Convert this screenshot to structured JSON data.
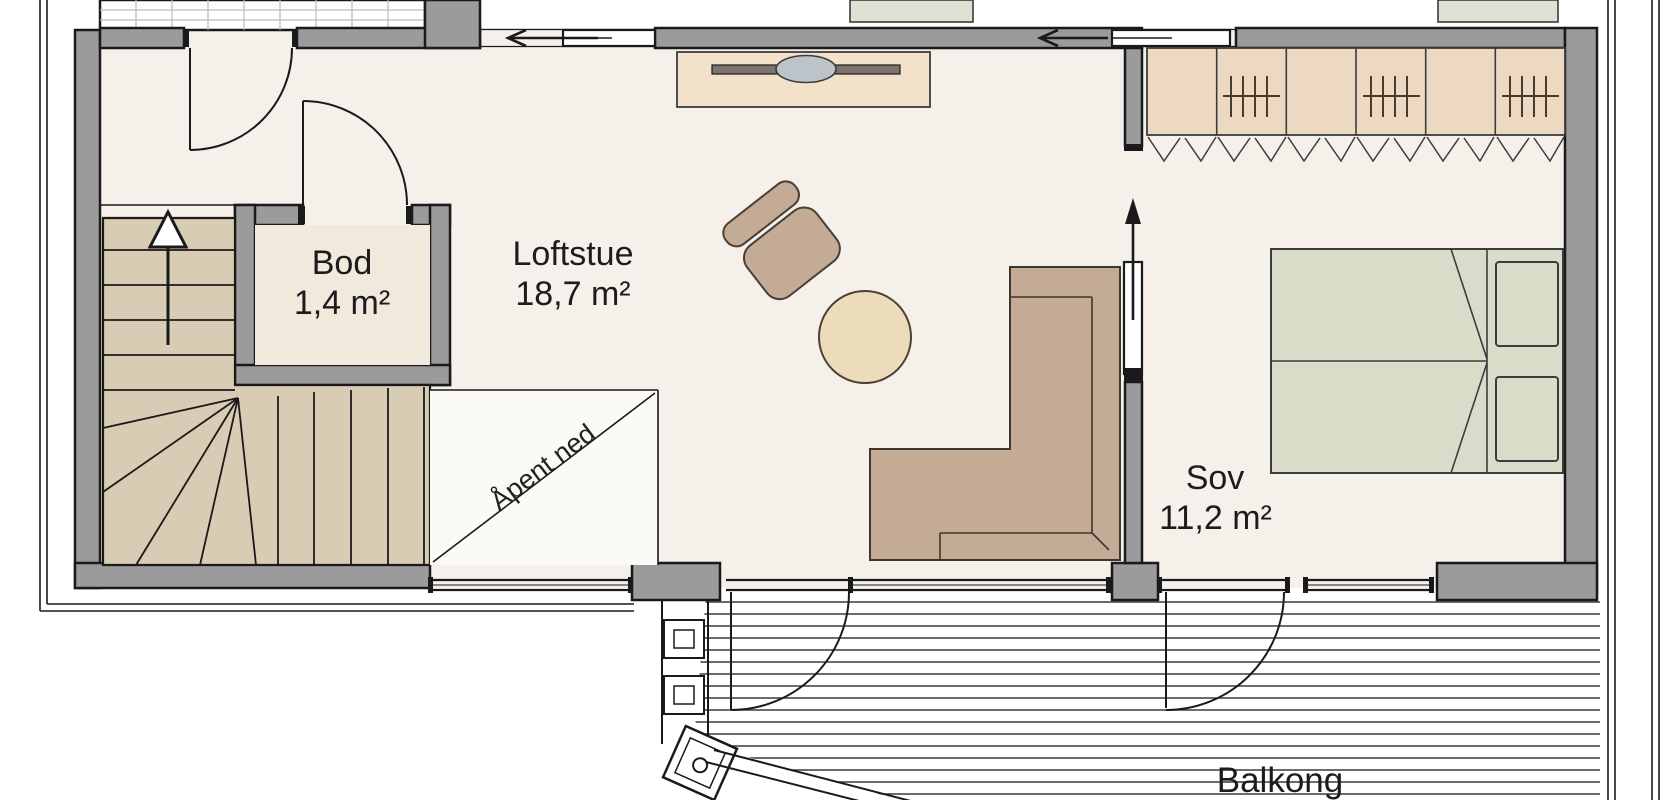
{
  "rooms": [
    {
      "name": "Bod",
      "area": "1,4 m²"
    },
    {
      "name": "Loftstue",
      "area": "18,7 m²"
    },
    {
      "name": "Sov",
      "area": "11,2 m²"
    }
  ],
  "annotations": {
    "open_below": "Åpent ned",
    "balcony": "Balkong"
  },
  "icons": [
    "stairs-up-arrow-icon",
    "sliding-door-left-arrow-icon",
    "sliding-door-up-arrow-icon",
    "wardrobe-hanger-icon",
    "door-swing-arc"
  ],
  "colors": {
    "floor": "#f5f1ea",
    "storage_floor": "#f2e9dd",
    "wall_gray": "#9b9b9b",
    "outline": "#1a1a1a",
    "stairs_wood": "#d8ccb4",
    "wardrobe": "#edd9c2",
    "tv_cabinet": "#f3e2c9",
    "sofa_chair": "#c3ab96",
    "round_table": "#eddcbc",
    "bed": "#dadcca",
    "outside_planter": "#dee1d3",
    "deck_line": "#3c3c3c"
  }
}
